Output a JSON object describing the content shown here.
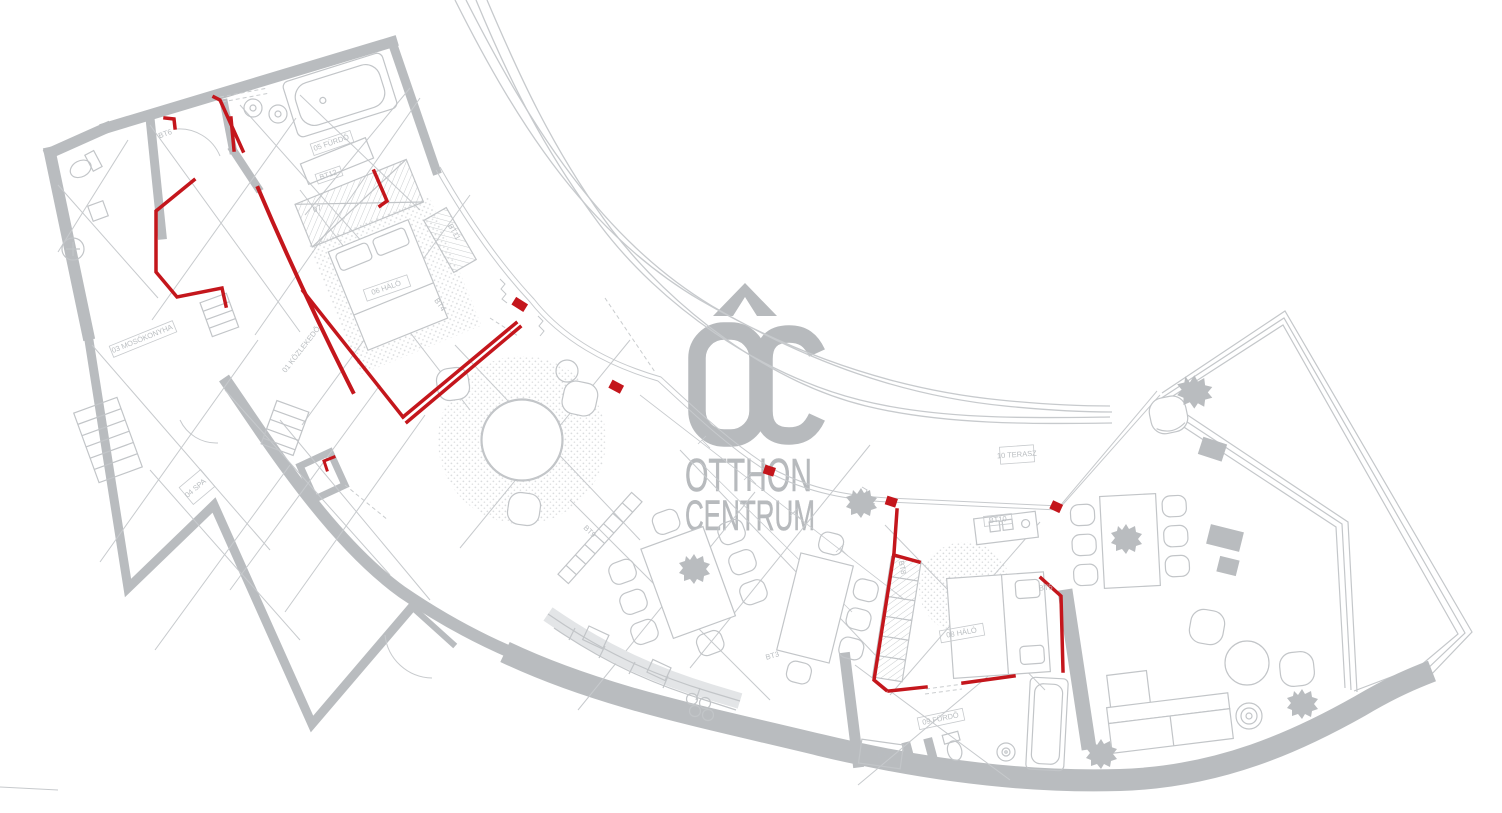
{
  "watermark": {
    "brand": "Otthon Centrum",
    "monogram": "OC",
    "line1": "OTTHON",
    "line2": "CENTRUM"
  },
  "palette": {
    "background": "#ffffff",
    "plan_line": "#c7cacd",
    "wall_gray": "#b9bcbf",
    "logo_gray": "#b7babd",
    "accent_red": "#c4161c"
  },
  "floor_plan": {
    "type": "apartment-floor-plan",
    "labels": [
      {
        "text": "BT6",
        "x": 166,
        "y": 136,
        "r": -20
      },
      {
        "text": "05 FÜRDŐ",
        "x": 332,
        "y": 145,
        "r": -19
      },
      {
        "text": "BT12",
        "x": 329,
        "y": 177,
        "r": -19
      },
      {
        "text": "07",
        "x": 318,
        "y": 211,
        "r": -19
      },
      {
        "text": "06 HÁLÓ",
        "x": 387,
        "y": 290,
        "r": -19
      },
      {
        "text": "BT11",
        "x": 452,
        "y": 233,
        "r": 60
      },
      {
        "text": "BT4",
        "x": 438,
        "y": 306,
        "r": 55
      },
      {
        "text": "01 KÖZLEKEDŐ",
        "x": 303,
        "y": 351,
        "r": -52
      },
      {
        "text": "03 MOSÓKONYHA",
        "x": 143,
        "y": 341,
        "r": -22
      },
      {
        "text": "04 SPA",
        "x": 197,
        "y": 490,
        "r": -40
      },
      {
        "text": "BT9",
        "x": 588,
        "y": 533,
        "r": 44
      },
      {
        "text": "BT3",
        "x": 773,
        "y": 658,
        "r": -16
      },
      {
        "text": "BT10",
        "x": 998,
        "y": 522,
        "r": -6
      },
      {
        "text": "BT8",
        "x": 900,
        "y": 568,
        "r": 78
      },
      {
        "text": "BT5",
        "x": 1046,
        "y": 590,
        "r": -6
      },
      {
        "text": "08 HÁLÓ",
        "x": 962,
        "y": 635,
        "r": -10
      },
      {
        "text": "09 FÜRDŐ",
        "x": 941,
        "y": 721,
        "r": -12
      },
      {
        "text": "BT1",
        "x": 885,
        "y": 757,
        "r": -12
      },
      {
        "text": "10 TERASZ",
        "x": 1017,
        "y": 457,
        "r": -4
      }
    ]
  }
}
